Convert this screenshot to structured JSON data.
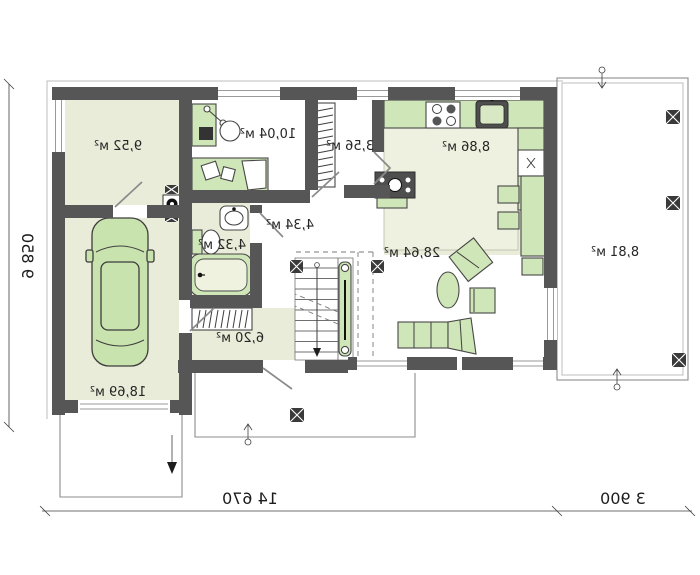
{
  "plan_title": "ground-floor-plan",
  "rooms": {
    "storage": {
      "area": "9,52 м²"
    },
    "garage": {
      "area": "18,69 м²"
    },
    "office": {
      "area": "10,04 м²"
    },
    "pantry": {
      "area": "3,56 м²"
    },
    "kitchen": {
      "area": "8,86 м²"
    },
    "living": {
      "area": "28,64 м²"
    },
    "hall": {
      "area": "4,34 м²"
    },
    "bathroom": {
      "area": "4,32 м²"
    },
    "vestibule": {
      "area": "6,20 м²"
    },
    "terrace": {
      "area": "8,81 м²"
    }
  },
  "dimensions": {
    "house_width": "14 670",
    "terrace_width": "3 900",
    "house_depth": "9 850"
  },
  "colors": {
    "wall": "#565656",
    "floor": "#e9ecd9",
    "furniture_green": "#cfe6b8",
    "outline_gray": "#9a9a9a"
  }
}
